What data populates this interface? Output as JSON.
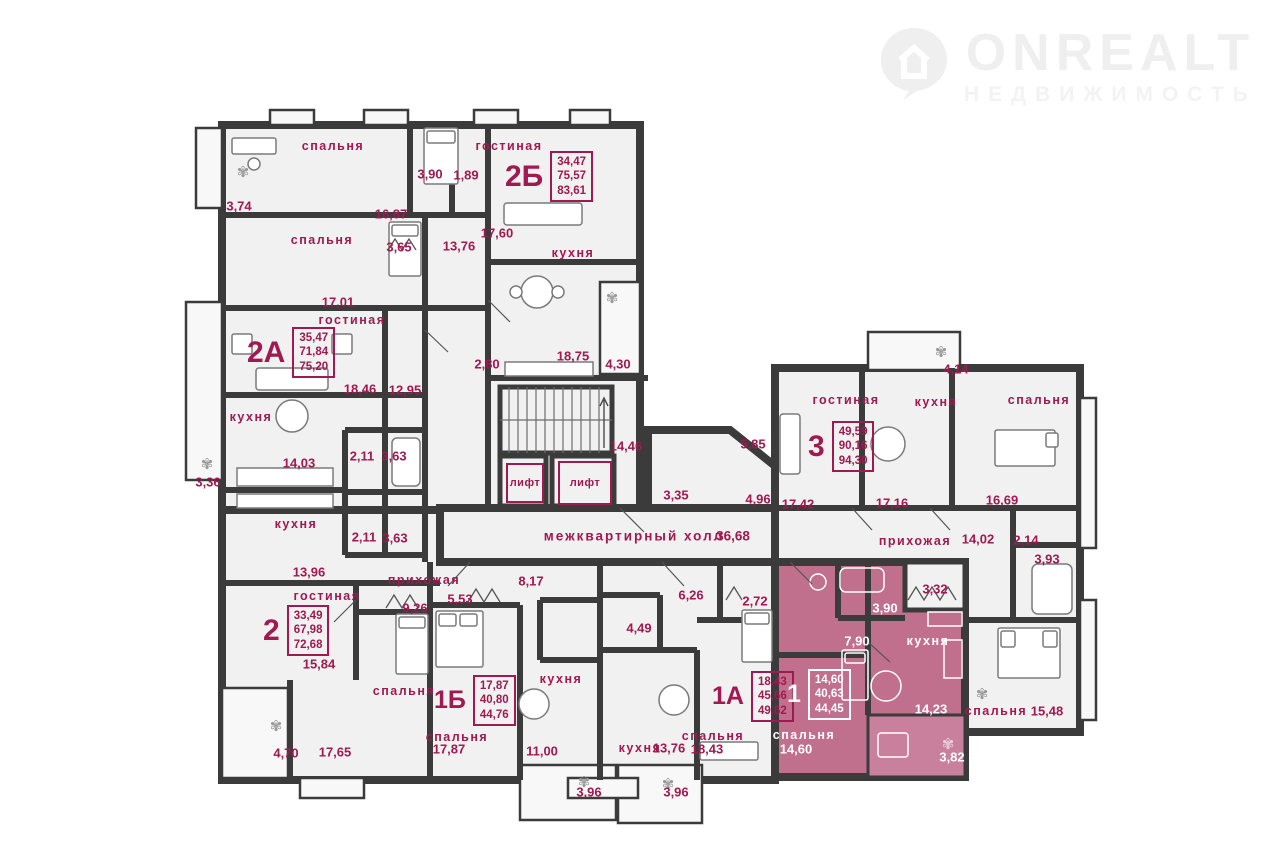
{
  "logo": {
    "brand": "ONREALT",
    "tagline": "НЕДВИЖИМОСТЬ"
  },
  "colors": {
    "wall": "#3b3b3b",
    "floor": "#f1f1f1",
    "balcony_floor": "#f8f8f8",
    "highlight": "#c06f8c",
    "highlight_loggia": "#c9809c",
    "accent_text": "#a01950",
    "light_text": "#ffffff",
    "logo_gray": "#efefef"
  },
  "hall": {
    "label": "межквартирный холл",
    "area": "36,68"
  },
  "elevator_label": "лифт",
  "apartments": [
    {
      "id": "2Б",
      "areas": [
        "34,47",
        "75,57",
        "83,61"
      ],
      "x": 505,
      "y": 151,
      "size": "lg",
      "light": false
    },
    {
      "id": "2А",
      "areas": [
        "35,47",
        "71,84",
        "75,20"
      ],
      "x": 247,
      "y": 327,
      "size": "lg",
      "light": false
    },
    {
      "id": "3",
      "areas": [
        "49,59",
        "90,16",
        "94,30"
      ],
      "x": 808,
      "y": 421,
      "size": "lg",
      "light": false
    },
    {
      "id": "2",
      "areas": [
        "33,49",
        "67,98",
        "72,68"
      ],
      "x": 263,
      "y": 605,
      "size": "lg",
      "light": false
    },
    {
      "id": "1Б",
      "areas": [
        "17,87",
        "40,80",
        "44,76"
      ],
      "x": 434,
      "y": 675,
      "size": "sm",
      "light": false
    },
    {
      "id": "1А",
      "areas": [
        "18,43",
        "45,66",
        "49,62"
      ],
      "x": 712,
      "y": 671,
      "size": "sm",
      "light": false
    },
    {
      "id": "1",
      "areas": [
        "14,60",
        "40,63",
        "44,45"
      ],
      "x": 787,
      "y": 669,
      "size": "sm",
      "light": true
    }
  ],
  "labels": [
    {
      "t": "спальня",
      "x": 333,
      "y": 146,
      "k": "room"
    },
    {
      "t": "гостиная",
      "x": 509,
      "y": 146,
      "k": "room"
    },
    {
      "t": "спальня",
      "x": 322,
      "y": 240,
      "k": "room"
    },
    {
      "t": "кухня",
      "x": 573,
      "y": 253,
      "k": "room"
    },
    {
      "t": "гостиная",
      "x": 352,
      "y": 320,
      "k": "room"
    },
    {
      "t": "кухня",
      "x": 251,
      "y": 417,
      "k": "room"
    },
    {
      "t": "кухня",
      "x": 296,
      "y": 524,
      "k": "room"
    },
    {
      "t": "гостиная",
      "x": 327,
      "y": 596,
      "k": "room"
    },
    {
      "t": "прихожая",
      "x": 424,
      "y": 580,
      "k": "room"
    },
    {
      "t": "спальня",
      "x": 404,
      "y": 691,
      "k": "room"
    },
    {
      "t": "спальня",
      "x": 457,
      "y": 737,
      "k": "room"
    },
    {
      "t": "кухня",
      "x": 561,
      "y": 679,
      "k": "room"
    },
    {
      "t": "кухня",
      "x": 640,
      "y": 748,
      "k": "room"
    },
    {
      "t": "спальня",
      "x": 713,
      "y": 736,
      "k": "room"
    },
    {
      "t": "гостиная",
      "x": 846,
      "y": 400,
      "k": "room"
    },
    {
      "t": "кухня",
      "x": 936,
      "y": 402,
      "k": "room"
    },
    {
      "t": "спальня",
      "x": 1039,
      "y": 400,
      "k": "room"
    },
    {
      "t": "прихожая",
      "x": 915,
      "y": 541,
      "k": "room"
    },
    {
      "t": "кухня",
      "x": 928,
      "y": 641,
      "k": "room",
      "c": "light"
    },
    {
      "t": "спальня",
      "x": 804,
      "y": 735,
      "k": "room",
      "c": "light"
    },
    {
      "t": "спальня",
      "x": 996,
      "y": 711,
      "k": "room"
    },
    {
      "t": "3,74",
      "x": 239,
      "y": 206,
      "k": "dim"
    },
    {
      "t": "3,90",
      "x": 430,
      "y": 174,
      "k": "dim"
    },
    {
      "t": "1,89",
      "x": 466,
      "y": 175,
      "k": "dim"
    },
    {
      "t": "16,87",
      "x": 391,
      "y": 214,
      "k": "dim"
    },
    {
      "t": "17,60",
      "x": 497,
      "y": 233,
      "k": "dim"
    },
    {
      "t": "3,65",
      "x": 399,
      "y": 247,
      "k": "dim"
    },
    {
      "t": "13,76",
      "x": 459,
      "y": 246,
      "k": "dim"
    },
    {
      "t": "17,01",
      "x": 338,
      "y": 302,
      "k": "dim"
    },
    {
      "t": "2,80",
      "x": 487,
      "y": 364,
      "k": "dim"
    },
    {
      "t": "18,75",
      "x": 573,
      "y": 356,
      "k": "dim"
    },
    {
      "t": "4,30",
      "x": 618,
      "y": 364,
      "k": "dim"
    },
    {
      "t": "18,46",
      "x": 360,
      "y": 389,
      "k": "dim"
    },
    {
      "t": "12,95",
      "x": 405,
      "y": 390,
      "k": "dim"
    },
    {
      "t": "14,03",
      "x": 299,
      "y": 463,
      "k": "dim"
    },
    {
      "t": "3,36",
      "x": 208,
      "y": 482,
      "k": "dim"
    },
    {
      "t": "2,11",
      "x": 362,
      "y": 456,
      "k": "dim"
    },
    {
      "t": "3,63",
      "x": 394,
      "y": 456,
      "k": "dim"
    },
    {
      "t": "2,11",
      "x": 364,
      "y": 537,
      "k": "dim"
    },
    {
      "t": "3,63",
      "x": 395,
      "y": 538,
      "k": "dim"
    },
    {
      "t": "13,96",
      "x": 309,
      "y": 572,
      "k": "dim"
    },
    {
      "t": "14,46",
      "x": 626,
      "y": 446,
      "k": "dim"
    },
    {
      "t": "3,35",
      "x": 676,
      "y": 495,
      "k": "dim"
    },
    {
      "t": "5,85",
      "x": 753,
      "y": 444,
      "k": "dim"
    },
    {
      "t": "4,96",
      "x": 758,
      "y": 499,
      "k": "dim"
    },
    {
      "t": "4,14",
      "x": 956,
      "y": 369,
      "k": "dim"
    },
    {
      "t": "17,42",
      "x": 798,
      "y": 504,
      "k": "dim"
    },
    {
      "t": "17,16",
      "x": 892,
      "y": 503,
      "k": "dim"
    },
    {
      "t": "16,69",
      "x": 1002,
      "y": 500,
      "k": "dim"
    },
    {
      "t": "14,02",
      "x": 978,
      "y": 539,
      "k": "dim"
    },
    {
      "t": "2,14",
      "x": 1026,
      "y": 540,
      "k": "dim"
    },
    {
      "t": "3,93",
      "x": 1047,
      "y": 559,
      "k": "dim"
    },
    {
      "t": "3,32",
      "x": 935,
      "y": 589,
      "k": "dim"
    },
    {
      "t": "3,90",
      "x": 885,
      "y": 608,
      "k": "dim",
      "c": "light"
    },
    {
      "t": "7,90",
      "x": 857,
      "y": 641,
      "k": "dim",
      "c": "light"
    },
    {
      "t": "14,23",
      "x": 931,
      "y": 709,
      "k": "dim",
      "c": "light"
    },
    {
      "t": "14,60",
      "x": 796,
      "y": 749,
      "k": "dim",
      "c": "light"
    },
    {
      "t": "3,82",
      "x": 952,
      "y": 757,
      "k": "dim",
      "c": "light"
    },
    {
      "t": "15,48",
      "x": 1047,
      "y": 711,
      "k": "dim"
    },
    {
      "t": "6,26",
      "x": 691,
      "y": 595,
      "k": "dim"
    },
    {
      "t": "2,72",
      "x": 755,
      "y": 601,
      "k": "dim"
    },
    {
      "t": "4,49",
      "x": 639,
      "y": 628,
      "k": "dim"
    },
    {
      "t": "18,43",
      "x": 707,
      "y": 749,
      "k": "dim"
    },
    {
      "t": "13,76",
      "x": 669,
      "y": 748,
      "k": "dim"
    },
    {
      "t": "3,96",
      "x": 589,
      "y": 792,
      "k": "dim"
    },
    {
      "t": "3,96",
      "x": 676,
      "y": 792,
      "k": "dim"
    },
    {
      "t": "5,53",
      "x": 460,
      "y": 599,
      "k": "dim"
    },
    {
      "t": "9,26",
      "x": 415,
      "y": 608,
      "k": "dim"
    },
    {
      "t": "8,17",
      "x": 531,
      "y": 581,
      "k": "dim"
    },
    {
      "t": "15,84",
      "x": 319,
      "y": 664,
      "k": "dim"
    },
    {
      "t": "17,87",
      "x": 449,
      "y": 749,
      "k": "dim"
    },
    {
      "t": "11,00",
      "x": 542,
      "y": 751,
      "k": "dim"
    },
    {
      "t": "4,70",
      "x": 286,
      "y": 753,
      "k": "dim"
    },
    {
      "t": "17,65",
      "x": 335,
      "y": 752,
      "k": "dim"
    }
  ]
}
